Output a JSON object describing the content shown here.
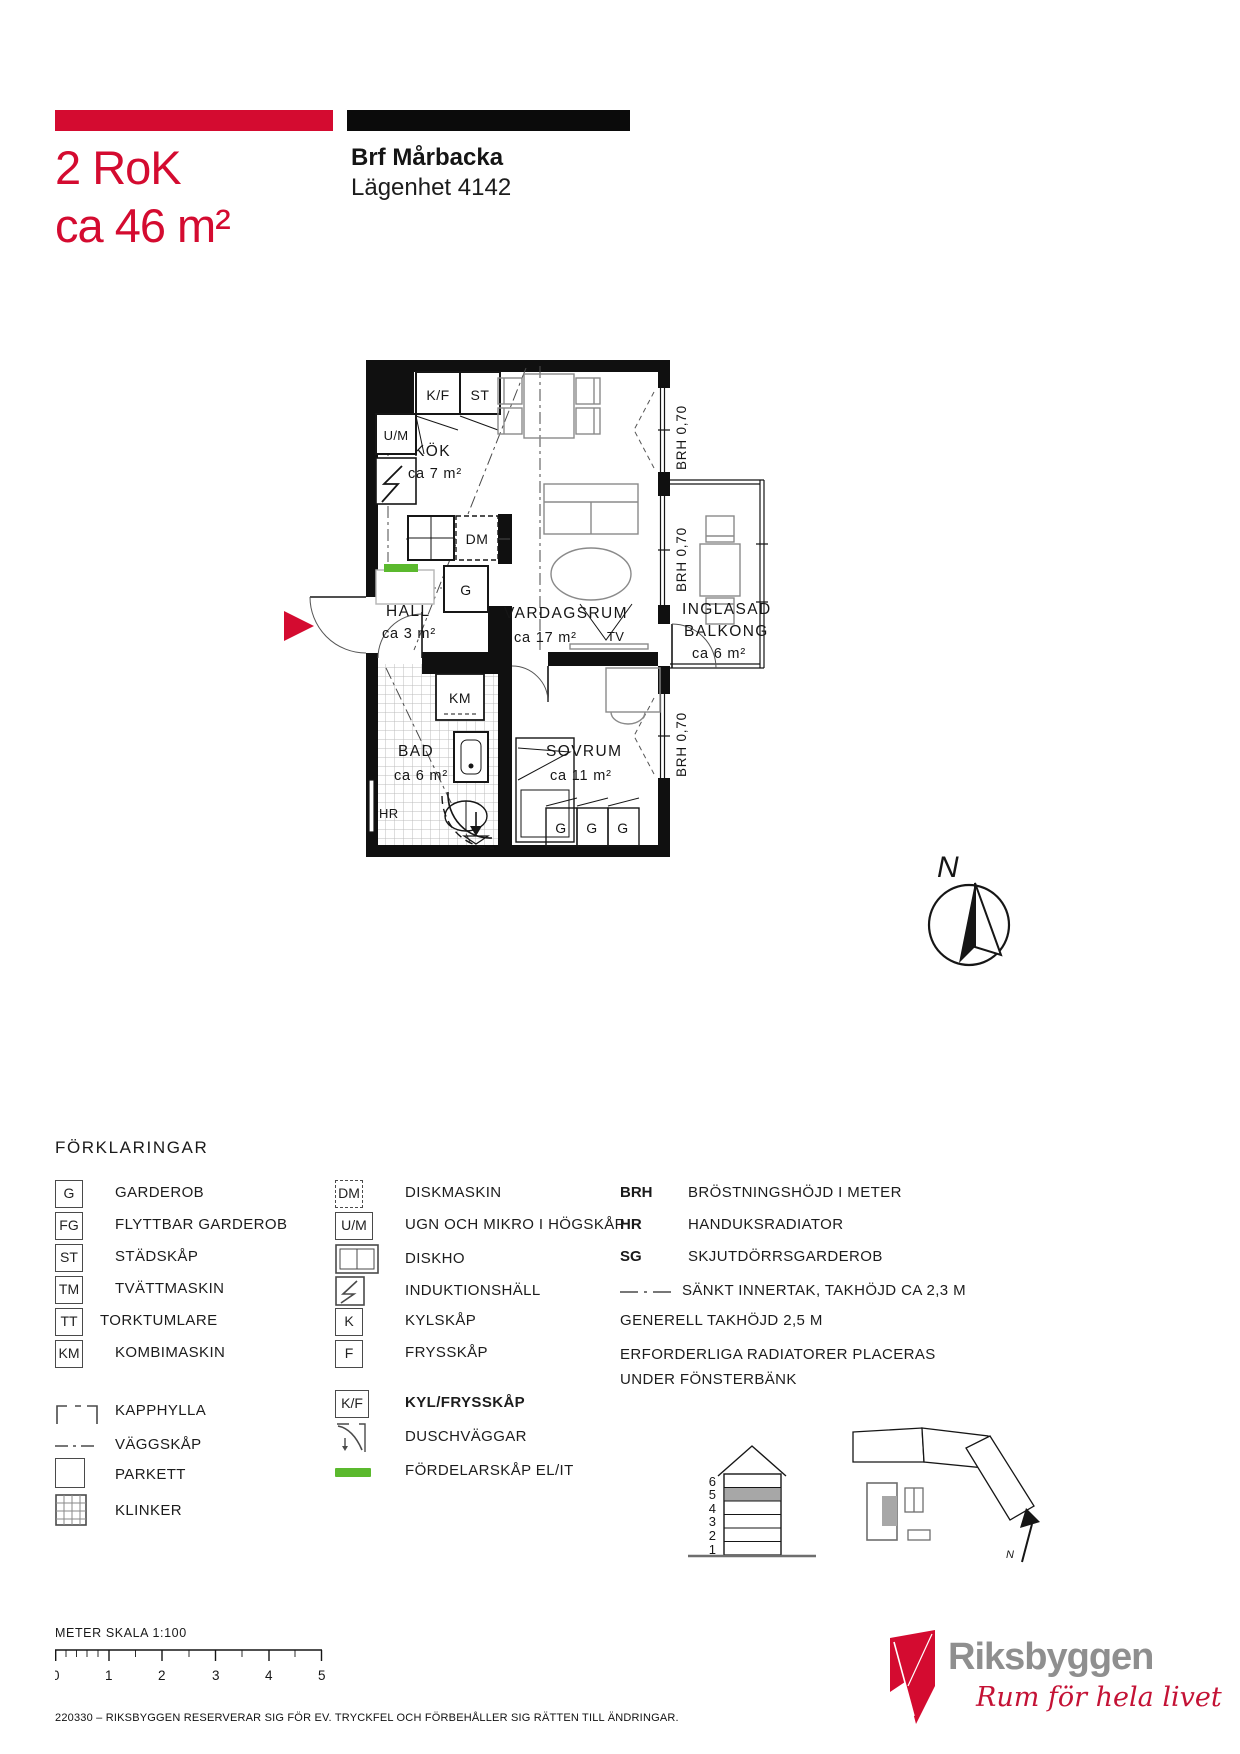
{
  "header": {
    "rok": "2 RoK",
    "area": "ca 46 m²",
    "project": "Brf Mårbacka",
    "apartment": "Lägenhet 4142"
  },
  "colors": {
    "brand_red": "#d40b30",
    "distribution_green": "#5bb92e",
    "floor_highlight_gray": "#a7a7a7",
    "logo_gray": "#8f8f8f",
    "tagline_red": "#c41235"
  },
  "plan": {
    "rooms": {
      "kok": {
        "name": "KÖK",
        "area": "ca 7 m²"
      },
      "hall": {
        "name": "HALL",
        "area": "ca 3 m²"
      },
      "vardagsrum": {
        "name": "VARDAGSRUM",
        "area": "ca 17 m²"
      },
      "bad": {
        "name": "BAD",
        "area": "ca 6 m²"
      },
      "sovrum": {
        "name": "SOVRUM",
        "area": "ca 11 m²"
      },
      "balkong": {
        "name1": "INGLASAD",
        "name2": "BALKONG",
        "area": "ca 6 m²"
      }
    },
    "fixtures": {
      "kf": "K/F",
      "st": "ST",
      "um": "U/M",
      "dm": "DM",
      "g_hall": "G",
      "km": "KM",
      "hr": "HR",
      "tv": "TV",
      "wardrobes": [
        "G",
        "G",
        "G"
      ]
    },
    "brh": [
      "BRH 0,70",
      "BRH 0,70",
      "BRH 0,70"
    ],
    "compass_north": "N"
  },
  "legend": {
    "title": "FÖRKLARINGAR",
    "col1": [
      {
        "abbr": "G",
        "label": "GARDEROB",
        "symbol": "box"
      },
      {
        "abbr": "FG",
        "label": "FLYTTBAR GARDEROB",
        "symbol": "box"
      },
      {
        "abbr": "ST",
        "label": "STÄDSKÅP",
        "symbol": "box"
      },
      {
        "abbr": "TM",
        "label": "TVÄTTMASKIN",
        "symbol": "box"
      },
      {
        "abbr": "TT",
        "label": "TORKTUMLARE",
        "symbol": "box"
      },
      {
        "abbr": "KM",
        "label": "KOMBIMASKIN",
        "symbol": "box"
      },
      {
        "label": "KAPPHYLLA",
        "symbol": "kapphylla-bracket"
      },
      {
        "label": "VÄGGSKÅP",
        "symbol": "dash-dot-line"
      },
      {
        "label": "PARKETT",
        "symbol": "plain-square"
      },
      {
        "label": "KLINKER",
        "symbol": "grid-square"
      }
    ],
    "col2": [
      {
        "abbr": "DM",
        "label": "DISKMASKIN",
        "symbol": "dashed-box"
      },
      {
        "abbr": "U/M",
        "label": "UGN OCH MIKRO  I HÖGSKÅP",
        "symbol": "box"
      },
      {
        "label": "DISKHO",
        "symbol": "sink"
      },
      {
        "label": "INDUKTIONSHÄLL",
        "symbol": "hob-lightning"
      },
      {
        "abbr": "K",
        "label": "KYLSKÅP",
        "symbol": "box"
      },
      {
        "abbr": "F",
        "label": "FRYSSKÅP",
        "symbol": "box"
      },
      {
        "abbr": "K/F",
        "label": "KYL/FRYSSKÅP",
        "symbol": "box"
      },
      {
        "label": "DUSCHVÄGGAR",
        "symbol": "shower"
      },
      {
        "label": "FÖRDELARSKÅP EL/IT",
        "symbol": "green-bar"
      }
    ],
    "col3": [
      {
        "abbr": "BRH",
        "label": "BRÖSTNINGSHÖJD I METER"
      },
      {
        "abbr": "HR",
        "label": "HANDUKSRADIATOR"
      },
      {
        "abbr": "SG",
        "label": "SKJUTDÖRRSGARDEROB"
      },
      {
        "label": "SÄNKT INNERTAK, TAKHÖJD CA 2,3 M",
        "symbol": "dash-dot-line"
      }
    ],
    "notes": [
      "GENERELL TAKHÖJD 2,5 M",
      "ERFORDERLIGA RADIATORER PLACERAS",
      "UNDER FÖNSTERBÄNK"
    ]
  },
  "locator": {
    "floors": [
      "6",
      "5",
      "4",
      "3",
      "2",
      "1"
    ],
    "highlighted_floor": "5",
    "north": "N"
  },
  "scalebar": {
    "label": "METER SKALA 1:100",
    "ticks": [
      "0",
      "1",
      "2",
      "3",
      "4",
      "5"
    ]
  },
  "footer": {
    "disclaimer": "220330 – RIKSBYGGEN RESERVERAR SIG FÖR EV. TRYCKFEL OCH FÖRBEHÅLLER SIG RÄTTEN TILL ÄNDRINGAR."
  },
  "logo": {
    "name": "Riksbyggen",
    "tagline": "Rum för hela livet"
  }
}
